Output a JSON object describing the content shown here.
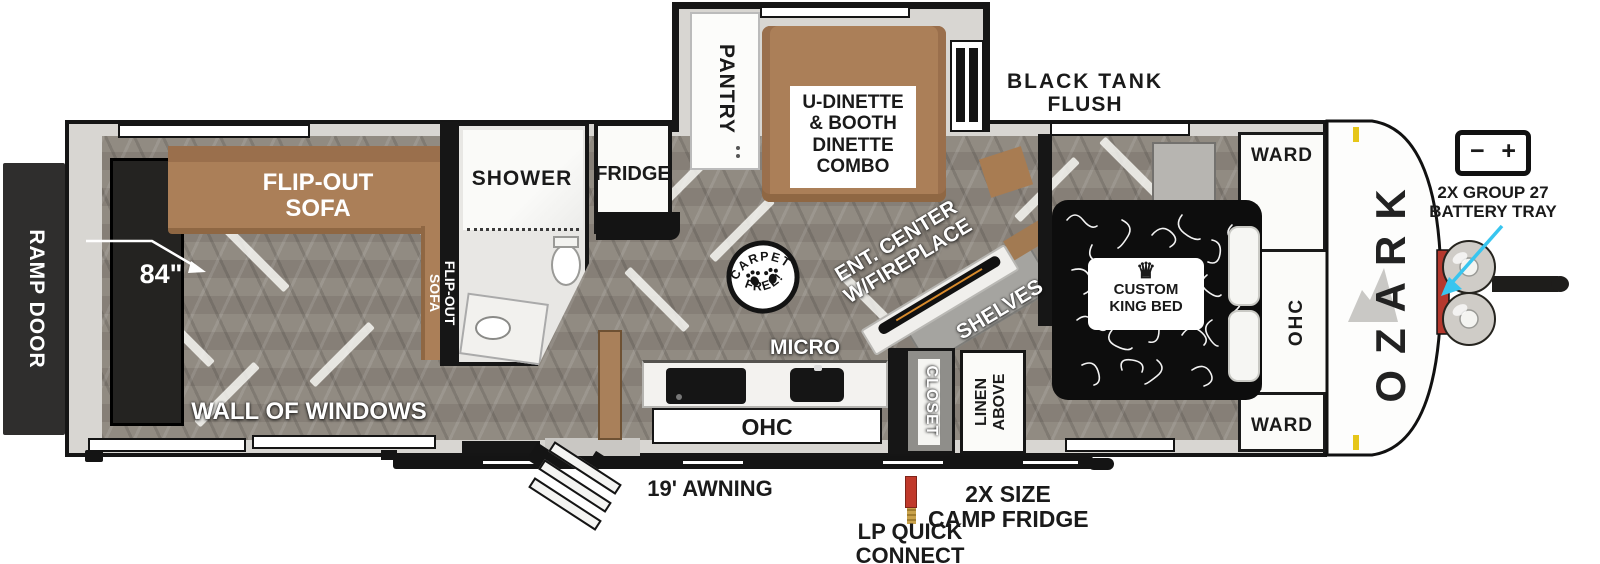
{
  "brand": "OZARK",
  "rear": {
    "ramp_door": "RAMP DOOR",
    "dim_84": "84\"",
    "wall_of_windows": "WALL OF WINDOWS",
    "sofa_top_l1": "FLIP-OUT",
    "sofa_top_l2": "SOFA",
    "sofa_side_l1": "FLIP-OUT",
    "sofa_side_l2": "SOFA"
  },
  "bath": {
    "shower": "SHOWER"
  },
  "kitchen": {
    "fridge": "FRIDGE",
    "micro": "MICRO",
    "ohc": "OHC"
  },
  "dinette": {
    "pantry": "PANTRY",
    "l1": "U-DINETTE",
    "l2": "& BOOTH",
    "l3": "DINETTE",
    "l4": "COMBO"
  },
  "living": {
    "ent_l1": "ENT. CENTER",
    "ent_l2": "W/FIREPLACE",
    "shelves": "SHELVES",
    "closet": "CLOSET",
    "linen_l1": "LINEN",
    "linen_l2": "ABOVE"
  },
  "bedroom": {
    "ward_top": "WARD",
    "ward_bottom": "WARD",
    "ohc": "OHC",
    "bed_l1": "CUSTOM",
    "bed_l2": "KING BED"
  },
  "badge": {
    "top": "CARPET",
    "bottom": "FREE!"
  },
  "exterior": {
    "black_tank_l1": "BLACK TANK",
    "black_tank_l2": "FLUSH",
    "awning": "19' AWNING",
    "lp_l1": "LP QUICK",
    "lp_l2": "CONNECT",
    "camp_l1": "2X SIZE",
    "camp_l2": "CAMP FRIDGE",
    "battery_l1": "2X GROUP 27",
    "battery_l2": "BATTERY TRAY"
  },
  "icons": {
    "crown": "♛",
    "battery_minus": "−",
    "battery_plus": "+"
  },
  "colors": {
    "wall_black": "#161616",
    "floor_gray": "#8d867d",
    "sofa_brown": "#ab7f58",
    "accent_cyan": "#38c5ef",
    "lp_red": "#c0392b",
    "lp_brass": "#c9a24b",
    "marker_amber": "#e6c619"
  }
}
